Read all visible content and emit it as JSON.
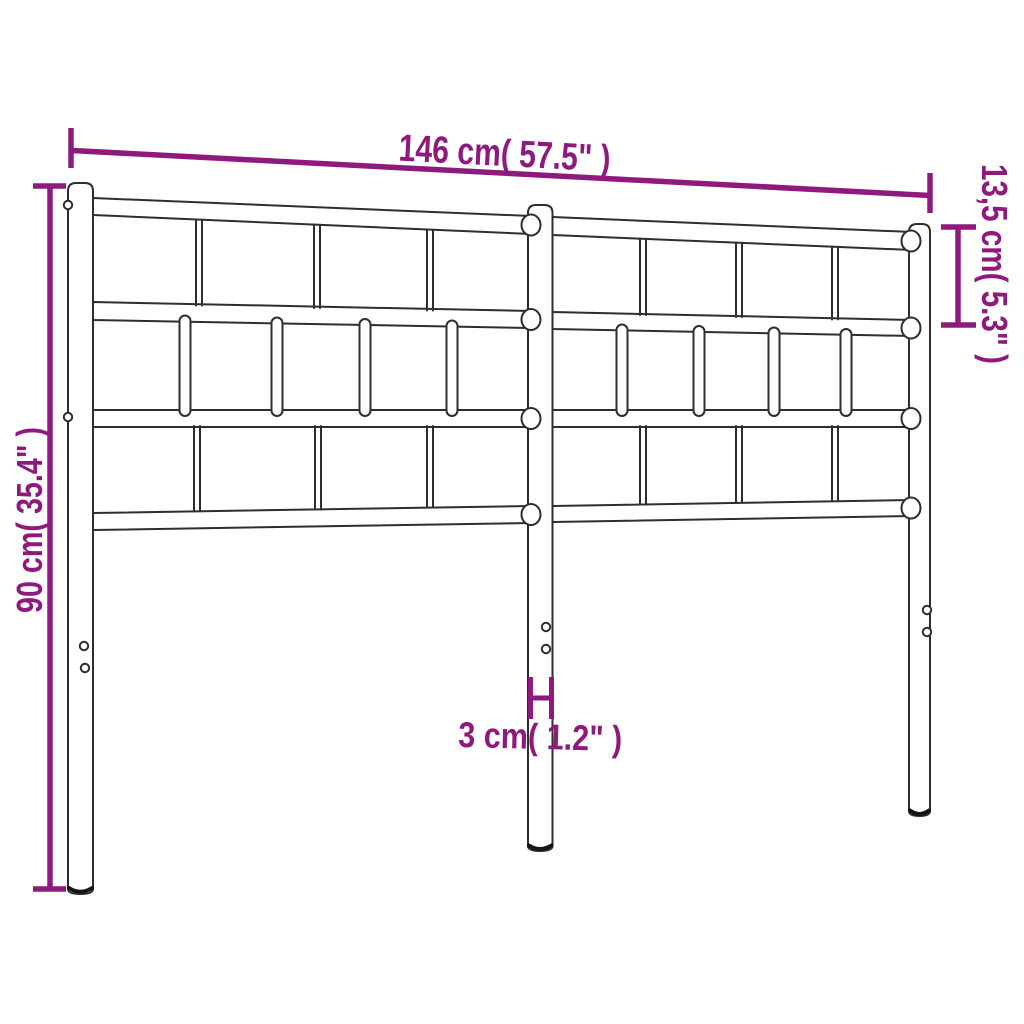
{
  "figure": {
    "subject": "metal-headboard-dimension-diagram",
    "colors": {
      "background": "#ffffff",
      "outline": "#2e2e2e",
      "dimension_accent": "#8e1a7e"
    },
    "dimensions": {
      "width": {
        "label": "146 cm( 57.5\" )",
        "metric": "146 cm",
        "imperial": "57.5\""
      },
      "height": {
        "label": "90 cm( 35.4\" )",
        "metric": "90 cm",
        "imperial": "35.4\""
      },
      "top_section": {
        "label": "13,5 cm( 5.3\" )",
        "metric": "13,5 cm",
        "imperial": "5.3\""
      },
      "post_width": {
        "label": "3 cm( 1.2\" )",
        "metric": "3 cm",
        "imperial": "1.2\""
      }
    }
  }
}
